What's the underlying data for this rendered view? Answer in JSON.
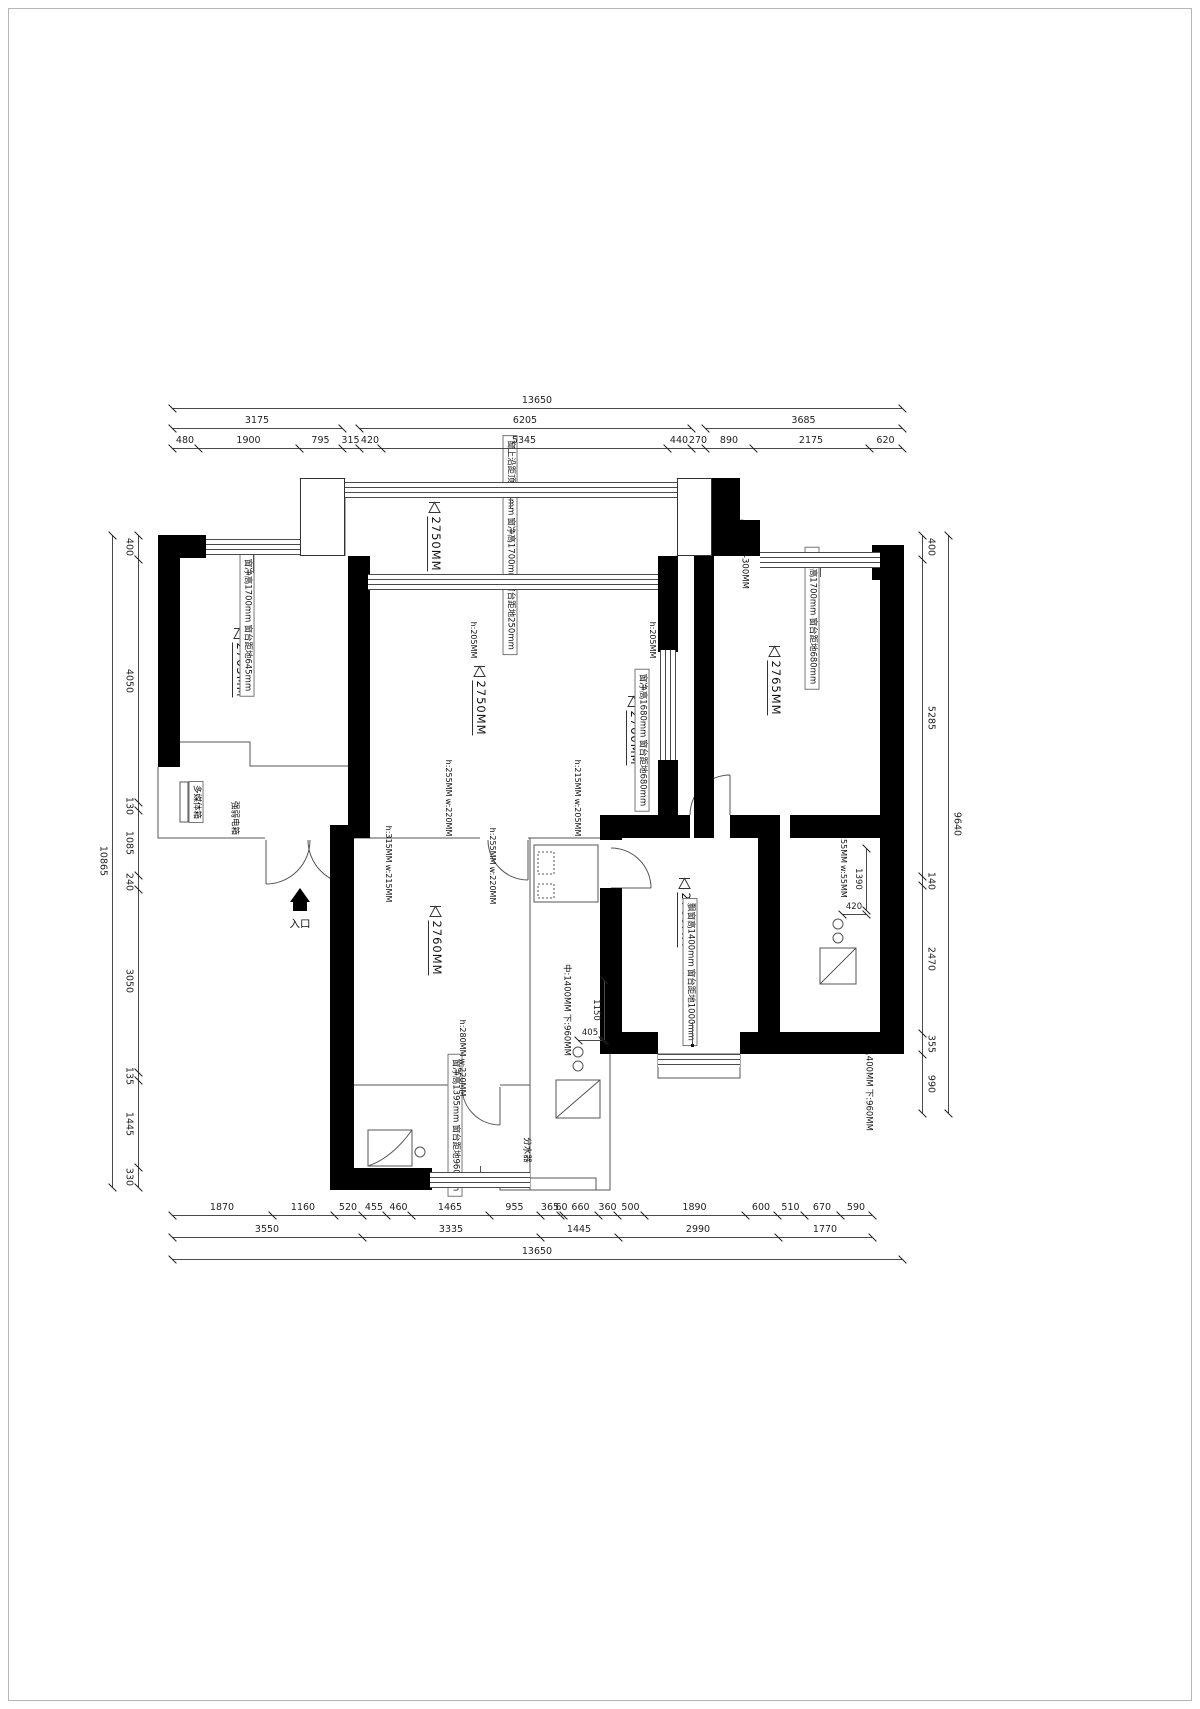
{
  "drawing": {
    "type": "floor-plan",
    "unit": "mm"
  },
  "dimensions": {
    "top": {
      "total": "13650",
      "row2": [
        "3175",
        "6205",
        "3685"
      ],
      "row3": [
        "480",
        "1900",
        "795",
        "315",
        "420",
        "5345",
        "440",
        "270",
        "890",
        "2175",
        "620"
      ]
    },
    "bottom": {
      "row1": [
        "1870",
        "1160",
        "520",
        "455",
        "460",
        "1465",
        "955",
        "365",
        "60",
        "660",
        "360",
        "500",
        "1890",
        "600",
        "510",
        "670",
        "590"
      ],
      "row2": [
        "3550",
        "3335",
        "1445",
        "2990",
        "1770"
      ],
      "total": "13650"
    },
    "left": {
      "total": "10865",
      "segments": [
        "400",
        "4050",
        "130",
        "1085",
        "240",
        "3050",
        "135",
        "1445",
        "330"
      ]
    },
    "right": {
      "total": "9640",
      "segments": [
        "400",
        "5285",
        "140",
        "2470",
        "355",
        "990"
      ]
    }
  },
  "interior_dimensions": {
    "d1": "1390",
    "d2": "420",
    "d3": "1150",
    "d4": "405"
  },
  "ceiling_heights": {
    "top_left_room": "2765MM",
    "balcony": "2750MM",
    "living_room": "2750MM",
    "dining_area": "2760MM",
    "top_right_room": "2765MM",
    "lower_left_room": "2760MM",
    "lower_right_room": "2760MM"
  },
  "window_notes": {
    "top_left": [
      "窗净高1700mm",
      "窗台距地645mm"
    ],
    "balcony": [
      "窗上沿距顶400mm",
      "窗净高1700mm",
      "窗台距地250mm"
    ],
    "top_right": [
      "窗净高1700mm",
      "窗台距地680mm"
    ],
    "dining": [
      "窗净高1680mm",
      "窗台距地680mm"
    ],
    "lower_right": [
      "飘窗高1400mm",
      "窗台距地1000mm"
    ],
    "bathroom": [
      "窗净高1395mm",
      "窗台距地960mm"
    ]
  },
  "beam_notes": {
    "b1": [
      "h:205MM"
    ],
    "b2": [
      "h:205MM"
    ],
    "b3": [
      "h:315MM",
      "w:215MM"
    ],
    "b4": [
      "h:255MM",
      "w:220MM"
    ],
    "b5": [
      "h:215MM",
      "w:205MM"
    ],
    "b6": [
      "h:255MM",
      "w:220MM"
    ],
    "b7": [
      "h:280MM",
      "w:220MM"
    ],
    "b8": [
      "h:255MM",
      "w:55MM"
    ]
  },
  "annotations": {
    "entrance": "入口",
    "drain": "下水:-300MM",
    "drain_code": "BL",
    "multimedia_box": "多媒体箱",
    "electric_box": "强弱电箱",
    "water_manifold": "分水器",
    "right_heights": [
      "中:1400MM",
      "下:960MM"
    ],
    "center_heights": [
      "中:1400MM",
      "下:960MM"
    ]
  },
  "colors": {
    "wall": "#000000",
    "line": "#4a4a4a",
    "text": "#1a1a1a",
    "frame": "#b5b5b5"
  }
}
